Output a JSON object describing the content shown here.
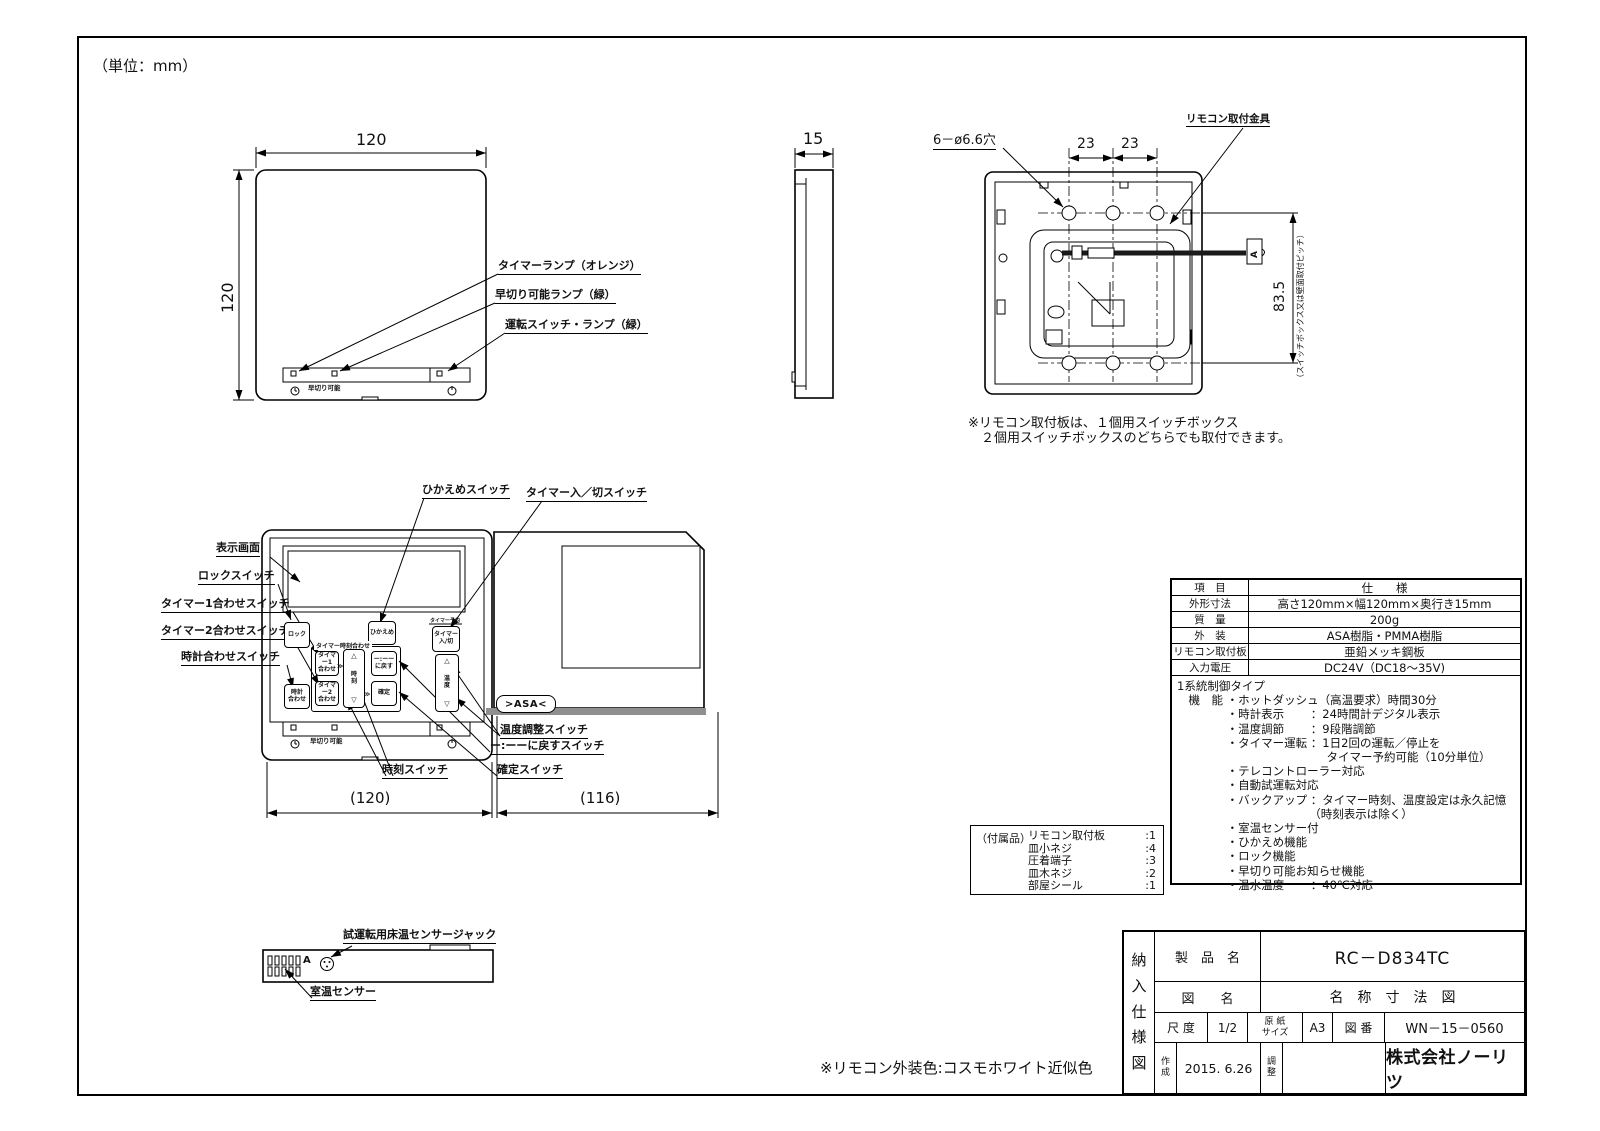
{
  "page": {
    "unit_note": "（単位：mm）"
  },
  "front_view": {
    "dim_width": "120",
    "dim_height": "120",
    "strip_text": "早切り可能",
    "callouts": {
      "timer_lamp": "タイマーランプ（オレンジ）",
      "early_lamp": "早切り可能ランプ（緑）",
      "power_lamp": "運転スイッチ・ランプ（緑）"
    }
  },
  "side_view": {
    "dim_depth": "15"
  },
  "rear_view": {
    "holes_label": "6－ø6.6穴",
    "pitch_left": "23",
    "pitch_right": "23",
    "bracket_label": "リモコン取付金具",
    "pitch_vertical": "83.5",
    "pitch_vertical_note": "（スイッチボックス又は壁面取付ピッチ）",
    "connector_mark": "A",
    "note": "※リモコン取付板は、１個用スイッチボックス\n　２個用スイッチボックスのどちらでも取付できます。"
  },
  "panel_view": {
    "dim_body": "(120)",
    "dim_cover": "(116)",
    "strip_text": "早切り可能",
    "logo": ">ASA<",
    "buttons": {
      "lock": "ロック",
      "hikaeme": "ひかえめ",
      "timer_onoff": "タイマー\n入/切",
      "timer_onoff_tag": "タイマー予約",
      "group_label": "タイマー時刻合わせ",
      "timer1": "タイマー1\n合わせ",
      "timer2": "タイマー2\n合わせ",
      "clock_set": "時計\n合わせ",
      "time": "時刻",
      "reset": "ー:ーー\nに戻す",
      "confirm": "確定",
      "temp": "温度",
      "tri_up": "△",
      "tri_down": "▽",
      "chev": "≫"
    },
    "callouts": {
      "display": "表示画面",
      "lock": "ロックスイッチ",
      "timer1": "タイマー1合わせスイッチ",
      "timer2": "タイマー2合わせスイッチ",
      "clock_set": "時計合わせスイッチ",
      "hikaeme": "ひかえめスイッチ",
      "timer_onoff": "タイマー入／切スイッチ",
      "temp": "温度調整スイッチ",
      "reset": "ー:ーーに戻すスイッチ",
      "time": "時刻スイッチ",
      "confirm": "確定スイッチ"
    }
  },
  "bottom_view": {
    "mark": "A",
    "callouts": {
      "jack": "試運転用床温センサージャック",
      "sensor": "室温センサー"
    }
  },
  "accessories": {
    "title": "（付属品）",
    "items": [
      {
        "name": "リモコン取付板",
        "qty": ":1"
      },
      {
        "name": "皿小ネジ",
        "qty": ":4"
      },
      {
        "name": "圧着端子",
        "qty": ":3"
      },
      {
        "name": "皿木ネジ",
        "qty": ":2"
      },
      {
        "name": "部屋シール",
        "qty": ":1"
      }
    ]
  },
  "spec_table": {
    "header": {
      "item": "項　目",
      "spec": "仕　　様"
    },
    "rows": [
      {
        "item": "外形寸法",
        "spec": "高さ120mm×幅120mm×奥行き15mm"
      },
      {
        "item": "質　量",
        "spec": "200g"
      },
      {
        "item": "外　装",
        "spec": "ASA樹脂・PMMA樹脂"
      },
      {
        "item": "リモコン取付板",
        "spec": "亜鉛メッキ鋼板"
      },
      {
        "item": "入力電圧",
        "spec": "DC24V（DC18～35V)"
      }
    ],
    "functions": "1系統制御タイプ\n　機　能 ・ホットダッシュ（高温要求）時間30分\n　　　　 ・時計表示　　 ：24時間計デジタル表示\n　　　　 ・温度調節　　 ：9段階調節\n　　　　 ・タイマー運転 ：1日2回の運転／停止を\n　　　　　　　　　　　　　タイマー予約可能（10分単位）\n　　　　 ・テレコントローラー対応\n　　　　 ・自動試運転対応\n　　　　 ・バックアップ ：タイマー時刻、温度設定は永久記憶\n　　　　　　　　　　　　（時刻表示は除く）\n　　　　 ・室温センサー付\n　　　　 ・ひかえめ機能\n　　　　 ・ロック機能\n　　　　 ・早切り可能お知らせ機能\n　　　　 ・温水温度　　 ：40℃対応"
  },
  "title_block": {
    "side_label": "納入仕様図",
    "product_label": "製　品　名",
    "product_value": "RC－D834TC",
    "drawing_label": "図　　名",
    "drawing_value": "名　称　寸　法　図",
    "scale_label": "尺 度",
    "scale_value": "1/2",
    "paper_label": "原 紙\nサイズ",
    "paper_value": "A3",
    "number_label": "図 番",
    "number_value": "WN－15－0560",
    "created_label": "作成",
    "created_value": "2015. 6.26",
    "adjust_label": "調整",
    "company": "株式会社ノーリツ"
  },
  "notes": {
    "exterior_color": "※リモコン外装色:コスモホワイト近似色"
  }
}
